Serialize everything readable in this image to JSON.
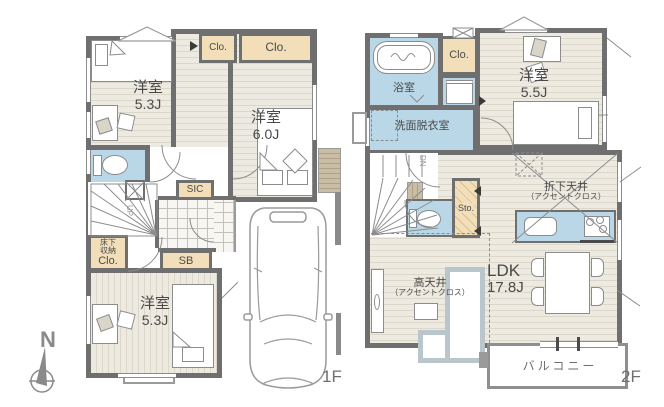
{
  "colors": {
    "wall": "#6f6f6f",
    "floor": "#edeae1",
    "floor_stripe": "#dcd7c9",
    "closet_beige": "#f2dfba",
    "wet_area_blue": "#b9d7e6",
    "step_tan": "#c9bda6",
    "sofa_trim": "#b9c6cc",
    "line_gray": "#8c8c8c",
    "text": "#4a4a4a"
  },
  "compass": {
    "north_label": "N"
  },
  "floor1": {
    "floor_label": "1F",
    "bedroom_top": {
      "name": "洋室",
      "size": "5.3J"
    },
    "bedroom_side": {
      "name": "洋室",
      "size": "6.0J"
    },
    "bedroom_bottom": {
      "name": "洋室",
      "size": "5.3J"
    },
    "closet_small_label": "Clo.",
    "closet_large_label": "Clo.",
    "shoes_in_closet_label": "SIC",
    "shoe_box_label": "SB",
    "underfloor_storage_caption": "床下収納",
    "underfloor_storage_label": "Clo.",
    "stairs_label": "UP"
  },
  "floor2": {
    "floor_label": "2F",
    "bathroom_label": "浴室",
    "closet_label": "Clo.",
    "washroom_label": "洗面脱衣室",
    "bedroom": {
      "name": "洋室",
      "size": "5.5J"
    },
    "stairs_label": "DN",
    "storage_label": "Sto.",
    "ldk": {
      "name": "LDK",
      "size": "17.8J"
    },
    "lowered_ceiling": {
      "line1": "折下天井",
      "line2": "（アクセントクロス）"
    },
    "high_ceiling": {
      "line1": "高天井",
      "line2": "（アクセントクロス）"
    },
    "balcony_label": "バルコニー"
  }
}
